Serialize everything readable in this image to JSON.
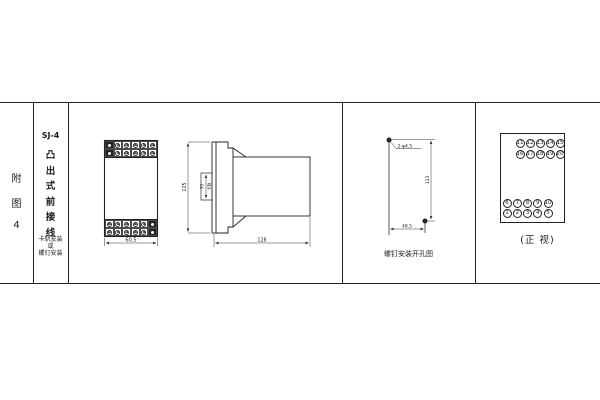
{
  "colors": {
    "line": "#222222",
    "background": "#ffffff"
  },
  "title_block": {
    "figure_chars": [
      "附",
      "图",
      "4"
    ],
    "model": "SJ-4",
    "type_chars": [
      "凸",
      "出",
      "式",
      "前",
      "接",
      "线"
    ],
    "mounting": [
      "卡轨安装",
      "或",
      "螺钉安装"
    ]
  },
  "front_view": {
    "width_dim": "60.5"
  },
  "side_view": {
    "height_dim": "125",
    "rail_dim": "35",
    "rail_label": "卡轨",
    "depth_dim": "128"
  },
  "drill_view": {
    "holes_label": "2-φ4.5",
    "vertical_dim": "113",
    "horizontal_dim": "48.5",
    "caption": "螺钉安装开孔图"
  },
  "terminal_view": {
    "rows": [
      [
        11,
        12,
        13,
        14,
        15
      ],
      [
        16,
        17,
        18,
        19,
        20
      ],
      [
        6,
        7,
        8,
        9,
        10
      ],
      [
        1,
        2,
        3,
        4,
        5
      ]
    ],
    "caption": "(正 视)"
  }
}
